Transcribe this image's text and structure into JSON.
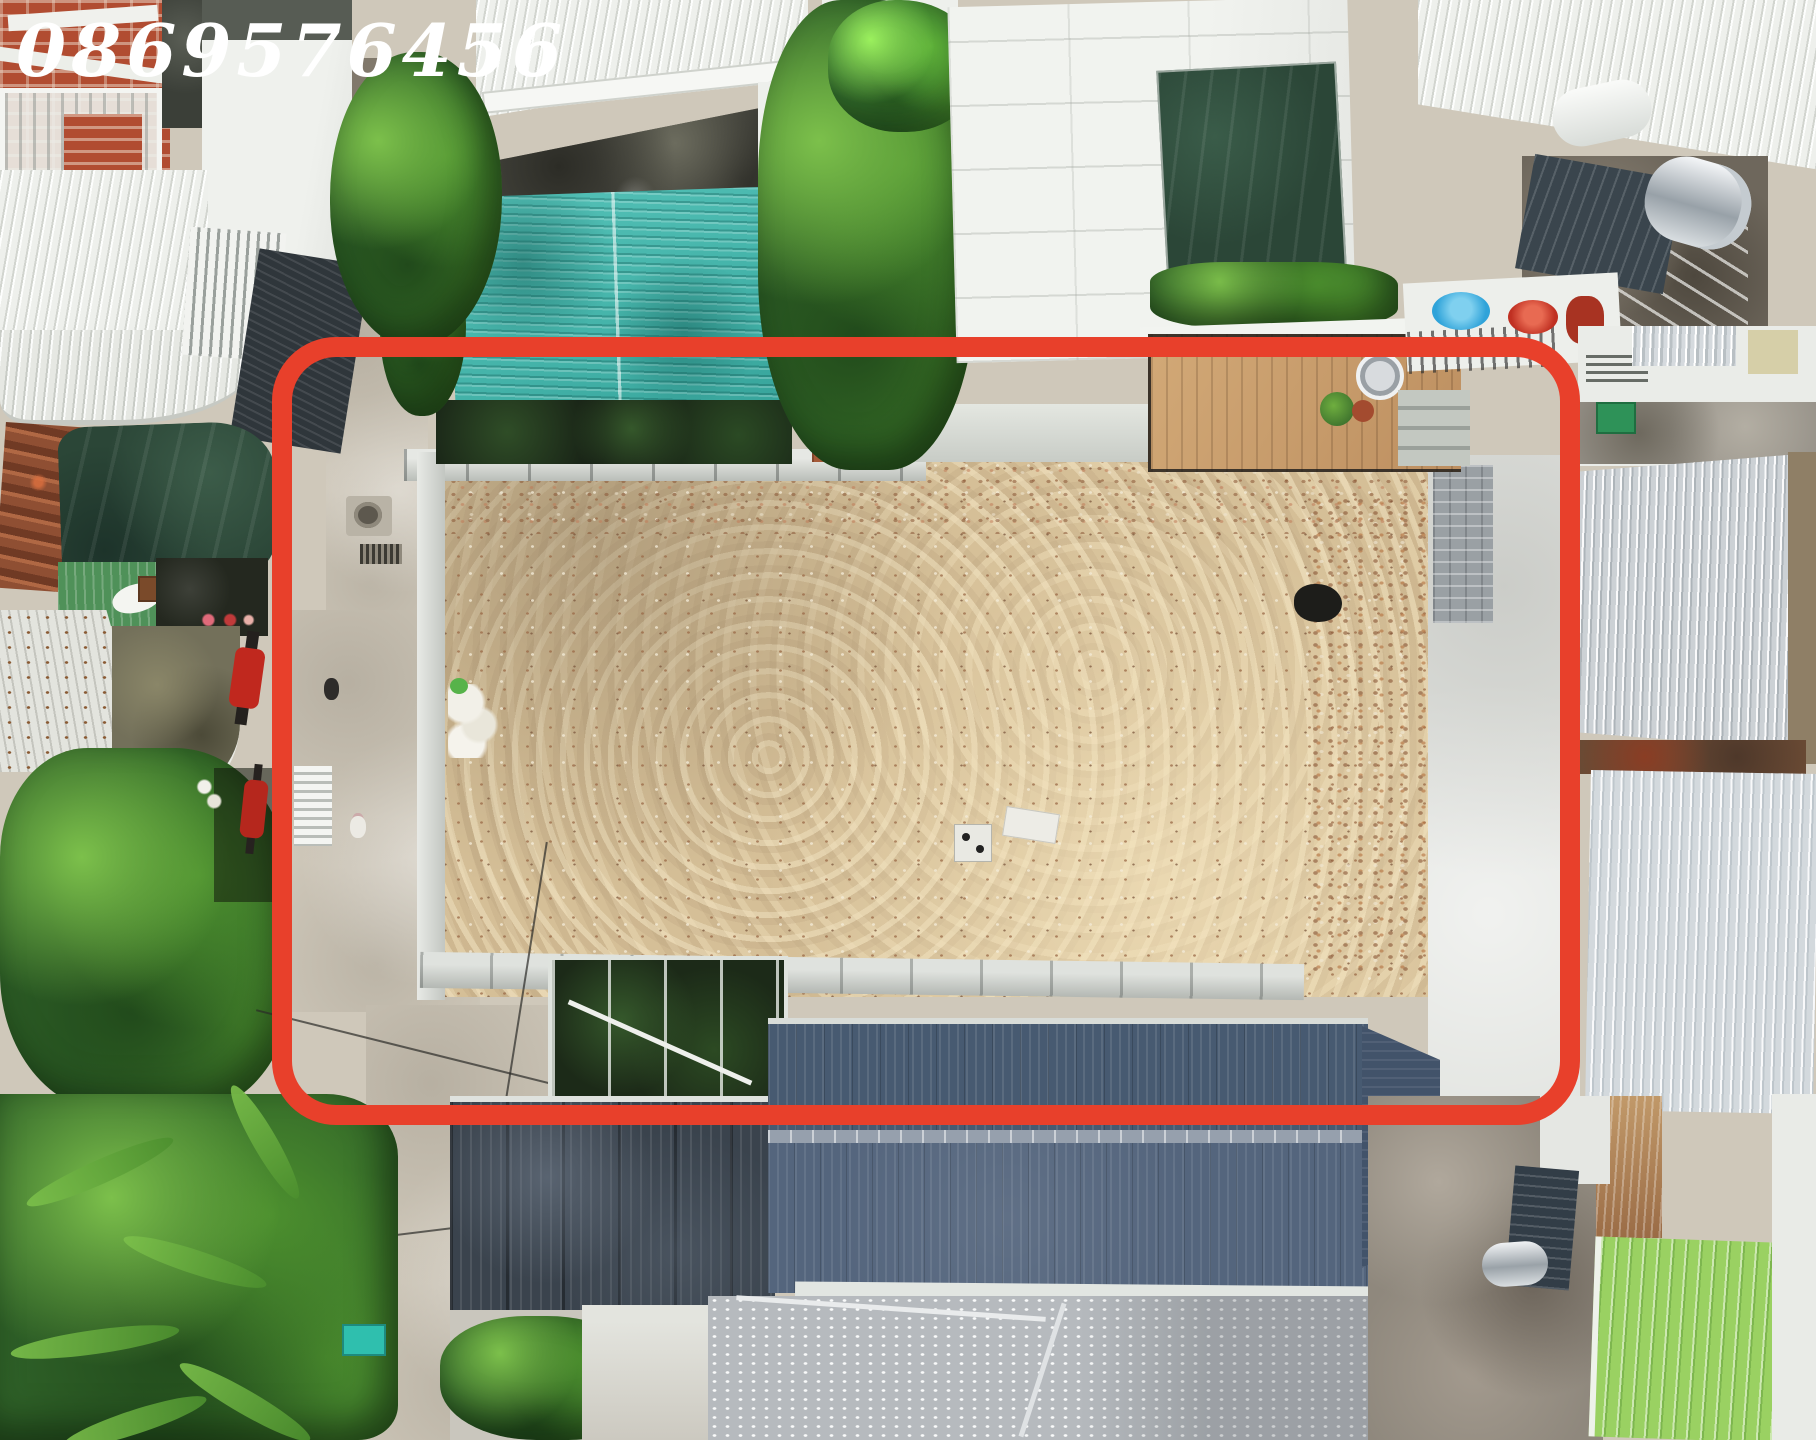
{
  "watermark": {
    "phone_number": "0869576456"
  },
  "scene": {
    "description": "Aerial drone photograph of a cleared sandy land plot outlined with a red rounded rectangle, surrounded by houses, tin roofs, alleys and tropical vegetation",
    "highlight_shape": "rounded-rectangle",
    "plot_surface": "graded sand with excavator tracks and rubble"
  },
  "colors": {
    "frame-red": "#e8402b",
    "watermark-white": "#ffffff",
    "sand": "#d5bf97",
    "teal-roof": "#45b4aa",
    "navy-roof": "#475a71",
    "navy-roof-light": "#54657d",
    "lime-roof": "#9ad162",
    "silver-roof": "#ccd1d5",
    "white-roof": "#eef0ec",
    "concrete": "#d0c9bb",
    "tarp-green": "#2b4637",
    "terracotta": "#a55a38",
    "brick-red": "#b14c31",
    "basin-blue": "#2fa3d9",
    "veg-dark": "#2f6128",
    "veg-mid": "#4c8f2e",
    "veg-bright": "#7cc04b"
  }
}
